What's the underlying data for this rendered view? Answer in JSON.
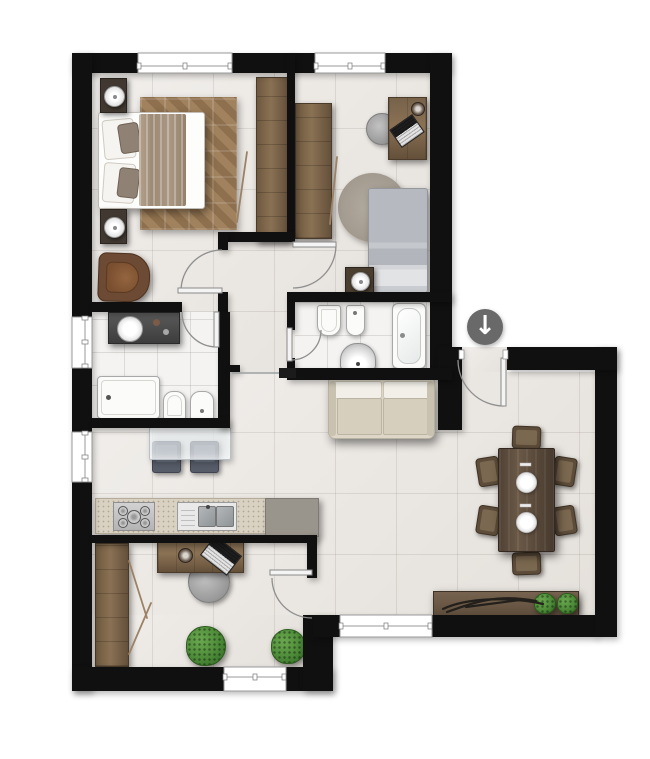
{
  "meta": {
    "title": "Furnished apartment floor plan",
    "view": "2D top-down render",
    "canvas": {
      "width": 650,
      "height": 759
    }
  },
  "colors": {
    "wall": "#101010",
    "floor": "#e9e5e0",
    "bath_floor": "#f4f3f1",
    "wood_mid": "#6b5947",
    "rug_brown": "#9b7c58",
    "fabric_cream": "#d7cfbd",
    "fabric_gray": "#b6bac0",
    "counter_speckle": "#d9d1c2",
    "counter_gray": "#99948c",
    "fixture_border": "#a8a8a8",
    "chair_slate": "#565c68",
    "plant_green": "#4f8c3c",
    "glass": "rgba(226,231,234,0.72)",
    "door_arc": "#8f8f8f",
    "entrance_badge": "#696969",
    "arrow_white": "#ffffff"
  },
  "entrance": {
    "icon": "down-arrow-icon",
    "glyph": "↓"
  },
  "openings": {
    "windows": 6,
    "interior_doors": 6,
    "entrance_doors": 1
  },
  "rooms": [
    {
      "id": "bedroom-1",
      "furniture": [
        "double-bed",
        "pillows",
        "throw-blanket",
        "patchwork-rug",
        "nightstand-with-lamp",
        "nightstand-with-lamp",
        "armchair",
        "wardrobe"
      ]
    },
    {
      "id": "bedroom-2",
      "furniture": [
        "single-bed",
        "round-rug",
        "desk",
        "laptop",
        "desk-chair",
        "nightstand-with-lamp",
        "wardrobe"
      ]
    },
    {
      "id": "bathroom-1",
      "furniture": [
        "vanity-counter",
        "round-washbasin",
        "shower-tray",
        "toilet",
        "bidet"
      ]
    },
    {
      "id": "bathroom-2",
      "furniture": [
        "toilet",
        "bidet",
        "washbasin",
        "bathtub"
      ]
    },
    {
      "id": "hallway",
      "furniture": []
    },
    {
      "id": "living-area",
      "furniture": [
        "sofa",
        "glass-table",
        "stool",
        "stool"
      ]
    },
    {
      "id": "kitchen",
      "furniture": [
        "worktop",
        "gas-hob",
        "double-sink",
        "peninsula-slab"
      ]
    },
    {
      "id": "dining-area",
      "furniture": [
        "dining-table",
        "dining-chair",
        "dining-chair",
        "dining-chair",
        "dining-chair",
        "dining-chair",
        "dining-chair",
        "place-setting",
        "place-setting",
        "sideboard-bench",
        "decor-sculpture",
        "potted-plant",
        "potted-plant"
      ]
    },
    {
      "id": "office",
      "furniture": [
        "wardrobe",
        "desk",
        "laptop",
        "coffee-cup",
        "swivel-chair",
        "potted-plant",
        "potted-plant"
      ]
    }
  ]
}
